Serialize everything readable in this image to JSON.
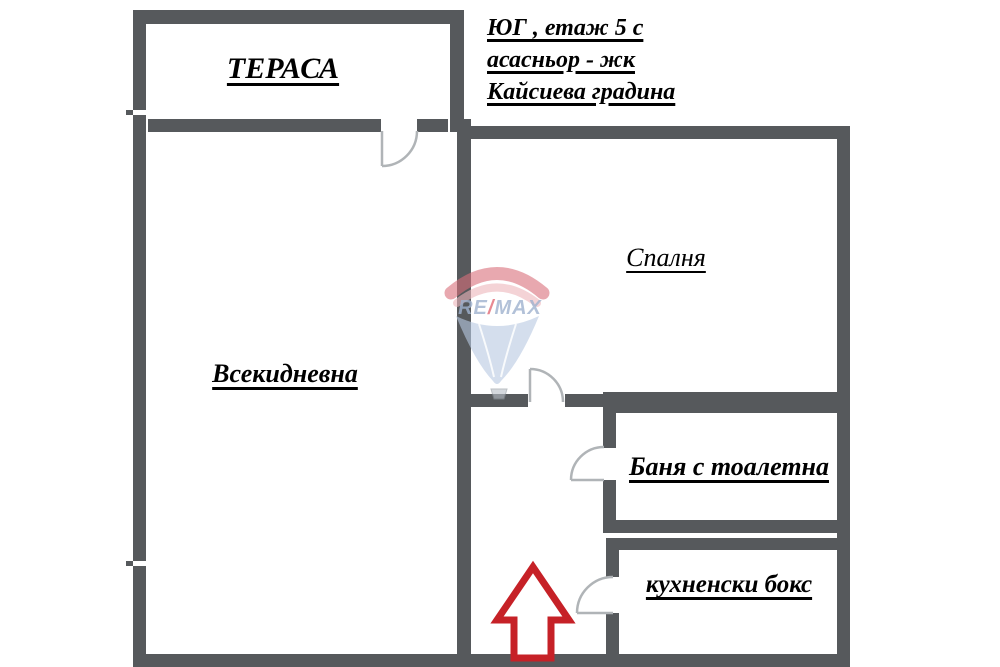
{
  "header": {
    "line1": "ЮГ , етаж 5 с",
    "line2": "асасньор - жк",
    "line3": "Кайсиева градина"
  },
  "rooms": {
    "terrace": "ТЕРАСА",
    "living": "Всекидневна",
    "bedroom": "Спалня",
    "bathroom": "Баня с тоалетна",
    "kitchen": "кухненски бокс"
  },
  "logo": {
    "re": "RE",
    "slash": "/",
    "max": "MAX"
  },
  "colors": {
    "wall": "#56595c",
    "entrance_arrow": "#c62127",
    "door_arc": "#b0b4b7",
    "logo_pink": "#d9707b",
    "logo_light_pink": "#eeb6bc",
    "logo_blue": "#b8c9e2",
    "logo_text": "#9fb2cf",
    "label_text": "#000000"
  }
}
